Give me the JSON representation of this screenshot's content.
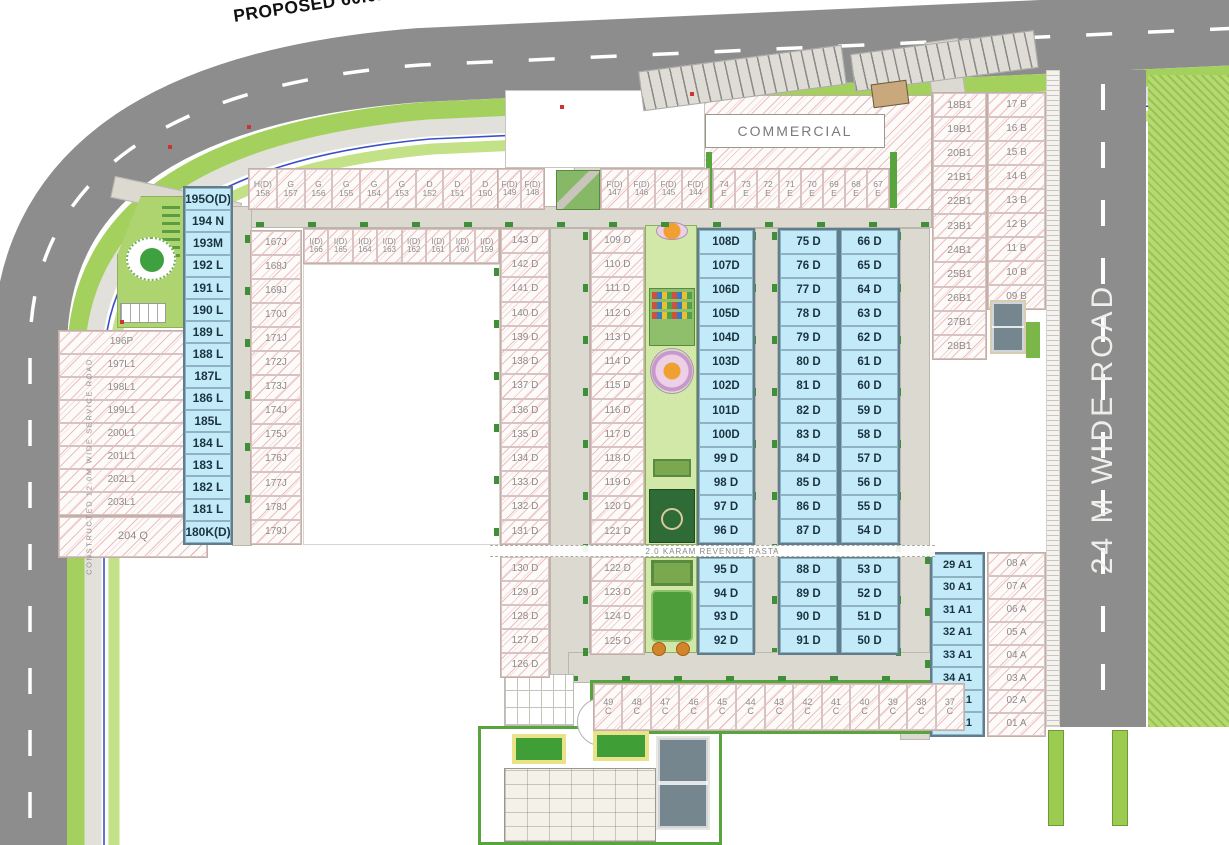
{
  "plan": {
    "proposed_road_label": "PROPOSED 60.0M WIDE ROAD",
    "right_road_label": "24 M WIDE ROAD",
    "service_road_label": "CONSTRUCTED 12.0M WIDE SERVICE ROAD",
    "revenue_rasta_label": "2.0 KARAM REVENUE RASTA",
    "commercial_label": "COMMERCIAL"
  },
  "palette": {
    "main_road": "#8d8d8d",
    "internal_road": "#dcd9d1",
    "plot_cyan": "#c3eaf8",
    "hatch_red": "#d67878",
    "verge_green": "#a4d05e",
    "lawn_green": "#d2e8a8",
    "utility_blue": "#3a50c8"
  },
  "plot_groups": [
    {
      "name": "196-204",
      "style": "hatch",
      "dir": "v",
      "x": 58,
      "y": 330,
      "w": 127,
      "h": 186,
      "font": 10,
      "labels": [
        "196P",
        "197L1",
        "198L1",
        "199L1",
        "200L1",
        "201L1",
        "202L1",
        "203L1"
      ]
    },
    {
      "name": "204Q",
      "style": "hatch",
      "dir": "v",
      "x": 58,
      "y": 516,
      "w": 150,
      "h": 42,
      "font": 11,
      "labels": [
        "204 Q"
      ]
    },
    {
      "name": "L-col",
      "style": "cyan",
      "dir": "v",
      "x": 183,
      "y": 186,
      "w": 50,
      "h": 359,
      "font": 12,
      "labels": [
        "195O(D)",
        "194 N",
        "193M",
        "192 L",
        "191 L",
        "190 L",
        "189 L",
        "188 L",
        "187L",
        "186 L",
        "185L",
        "184 L",
        "183 L",
        "182 L",
        "181 L",
        "180K(D)"
      ]
    },
    {
      "name": "J-col",
      "style": "hatch",
      "dir": "v",
      "x": 250,
      "y": 230,
      "w": 52,
      "h": 315,
      "font": 10,
      "labels": [
        "167J",
        "168J",
        "169J",
        "170J",
        "171J",
        "172J",
        "173J",
        "174J",
        "175J",
        "176J",
        "177J",
        "178J",
        "179J"
      ]
    },
    {
      "name": "HD-row",
      "style": "hatch",
      "dir": "h",
      "x": 248,
      "y": 168,
      "w": 252,
      "h": 42,
      "font": 8.5,
      "labels": [
        "H(D)\n158",
        "G\n157",
        "G\n156",
        "G\n155",
        "G\n154",
        "G\n153",
        "D\n152",
        "D\n151",
        "D\n150"
      ]
    },
    {
      "name": "FD-row-1",
      "style": "hatch",
      "dir": "h",
      "x": 497,
      "y": 168,
      "w": 48,
      "h": 42,
      "font": 8,
      "labels": [
        "F(D)\n149",
        "F(D)\n148"
      ]
    },
    {
      "name": "FD-row-2",
      "style": "hatch",
      "dir": "h",
      "x": 600,
      "y": 168,
      "w": 110,
      "h": 42,
      "font": 8,
      "labels": [
        "F(D)\n147",
        "F(D)\n146",
        "F(D)\n145",
        "F(D)\n144"
      ]
    },
    {
      "name": "E-row",
      "style": "hatch",
      "dir": "h",
      "x": 712,
      "y": 168,
      "w": 178,
      "h": 42,
      "font": 8.5,
      "labels": [
        "74\nE",
        "73\nE",
        "72\nE",
        "71\nE",
        "70\nE",
        "69\nE",
        "68\nE",
        "67\nE"
      ]
    },
    {
      "name": "ID-row",
      "style": "hatch",
      "dir": "h",
      "x": 303,
      "y": 228,
      "w": 197,
      "h": 36,
      "font": 8,
      "labels": [
        "I(D)\n166",
        "I(D)\n165",
        "I(D)\n164",
        "I(D)\n163",
        "I(D)\n162",
        "I(D)\n161",
        "I(D)\n160",
        "I(D)\n159"
      ]
    },
    {
      "name": "D-143",
      "style": "hatch",
      "dir": "v",
      "x": 500,
      "y": 228,
      "w": 50,
      "h": 317,
      "font": 10,
      "labels": [
        "143 D",
        "142 D",
        "141 D",
        "140 D",
        "139 D",
        "138 D",
        "137 D",
        "136 D",
        "135 D",
        "134 D",
        "133 D",
        "132 D",
        "131 D"
      ]
    },
    {
      "name": "D-130",
      "style": "hatch",
      "dir": "v",
      "x": 500,
      "y": 556,
      "w": 50,
      "h": 122,
      "font": 10,
      "labels": [
        "130 D",
        "129 D",
        "128 D",
        "127 D",
        "126 D"
      ]
    },
    {
      "name": "D-109",
      "style": "hatch",
      "dir": "v",
      "x": 590,
      "y": 228,
      "w": 55,
      "h": 317,
      "font": 10,
      "labels": [
        "109 D",
        "110 D",
        "111 D",
        "112 D",
        "113 D",
        "114 D",
        "115 D",
        "116 D",
        "117 D",
        "118 D",
        "119 D",
        "120 D",
        "121 D"
      ]
    },
    {
      "name": "D-122",
      "style": "hatch",
      "dir": "v",
      "x": 590,
      "y": 556,
      "w": 55,
      "h": 99,
      "font": 10,
      "labels": [
        "122 D",
        "123 D",
        "124 D",
        "125 D"
      ]
    },
    {
      "name": "D-108",
      "style": "cyan",
      "dir": "v",
      "x": 697,
      "y": 228,
      "w": 58,
      "h": 317,
      "font": 11.5,
      "labels": [
        "108D",
        "107D",
        "106D",
        "105D",
        "104D",
        "103D",
        "102D",
        "101D",
        "100D",
        "99 D",
        "98 D",
        "97 D",
        "96 D"
      ]
    },
    {
      "name": "D-95",
      "style": "cyan",
      "dir": "v",
      "x": 697,
      "y": 556,
      "w": 58,
      "h": 99,
      "font": 11.5,
      "labels": [
        "95 D",
        "94 D",
        "93 D",
        "92 D"
      ]
    },
    {
      "name": "D-75",
      "style": "cyan",
      "dir": "v",
      "x": 778,
      "y": 228,
      "w": 61,
      "h": 317,
      "font": 11.5,
      "labels": [
        "75 D",
        "76 D",
        "77 D",
        "78 D",
        "79 D",
        "80 D",
        "81 D",
        "82 D",
        "83 D",
        "84 D",
        "85 D",
        "86 D",
        "87 D"
      ]
    },
    {
      "name": "D-66",
      "style": "cyan",
      "dir": "v",
      "x": 839,
      "y": 228,
      "w": 61,
      "h": 317,
      "font": 11.5,
      "labels": [
        "66 D",
        "65 D",
        "64 D",
        "63 D",
        "62 D",
        "61 D",
        "60 D",
        "59 D",
        "58 D",
        "57 D",
        "56 D",
        "55 D",
        "54 D"
      ]
    },
    {
      "name": "D-88",
      "style": "cyan",
      "dir": "v",
      "x": 778,
      "y": 556,
      "w": 61,
      "h": 99,
      "font": 11.5,
      "labels": [
        "88 D",
        "89 D",
        "90 D",
        "91 D"
      ]
    },
    {
      "name": "D-53",
      "style": "cyan",
      "dir": "v",
      "x": 839,
      "y": 556,
      "w": 61,
      "h": 99,
      "font": 11.5,
      "labels": [
        "53 D",
        "52 D",
        "51 D",
        "50 D"
      ]
    },
    {
      "name": "A1-col",
      "style": "cyan",
      "dir": "v",
      "x": 930,
      "y": 552,
      "w": 55,
      "h": 185,
      "font": 11,
      "labels": [
        "29 A1",
        "30 A1",
        "31 A1",
        "32 A1",
        "33 A1",
        "34 A1",
        "35 A1",
        "36 A1"
      ]
    },
    {
      "name": "A-col",
      "style": "hatch",
      "dir": "v",
      "x": 987,
      "y": 552,
      "w": 59,
      "h": 185,
      "font": 10,
      "labels": [
        "08 A",
        "07 A",
        "06 A",
        "05 A",
        "04 A",
        "03 A",
        "02 A",
        "01 A"
      ]
    },
    {
      "name": "B1-col",
      "style": "hatch",
      "dir": "v",
      "x": 932,
      "y": 92,
      "w": 55,
      "h": 268,
      "font": 10.5,
      "labels": [
        "18B1",
        "19B1",
        "20B1",
        "21B1",
        "22B1",
        "23B1",
        "24B1",
        "25B1",
        "26B1",
        "27B1",
        "28B1"
      ]
    },
    {
      "name": "B-col",
      "style": "hatch",
      "dir": "v",
      "x": 987,
      "y": 92,
      "w": 59,
      "h": 218,
      "font": 10,
      "labels": [
        "17 B",
        "16 B",
        "15 B",
        "14 B",
        "13 B",
        "12 B",
        "11 B",
        "10 B",
        "09 B"
      ]
    },
    {
      "name": "C-row",
      "style": "hatch",
      "dir": "h",
      "x": 593,
      "y": 683,
      "w": 372,
      "h": 48,
      "font": 9,
      "labels": [
        "49\nC",
        "48\nC",
        "47\nC",
        "46\nC",
        "45\nC",
        "44\nC",
        "43\nC",
        "42\nC",
        "41\nC",
        "40\nC",
        "39\nC",
        "38\nC",
        "37\nC"
      ]
    }
  ]
}
